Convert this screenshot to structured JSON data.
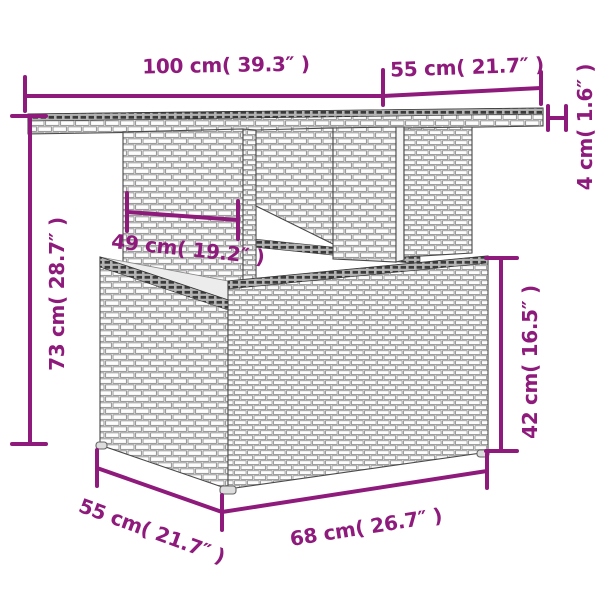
{
  "accent_color": "#8E1B7B",
  "line_art_color": "#4a4a4a",
  "dims": {
    "tabletop_width": {
      "label": "100 cm( 39.3″ )",
      "cm": 100,
      "inches": 39.3
    },
    "tabletop_depth": {
      "label": "55 cm( 21.7″ )",
      "cm": 55,
      "inches": 21.7
    },
    "tabletop_thickness": {
      "label": "4 cm( 1.6″ )",
      "cm": 4,
      "inches": 1.6
    },
    "table_height": {
      "label": "73 cm( 28.7″ )",
      "cm": 73,
      "inches": 28.7
    },
    "pedestal_width": {
      "label": "49 cm( 19.2″ )",
      "cm": 49,
      "inches": 19.2
    },
    "base_height": {
      "label": "42 cm( 16.5″ )",
      "cm": 42,
      "inches": 16.5
    },
    "base_depth": {
      "label": "55 cm( 21.7″ )",
      "cm": 55,
      "inches": 21.7
    },
    "base_width": {
      "label": "68 cm( 26.7″ )",
      "cm": 68,
      "inches": 26.7
    }
  }
}
